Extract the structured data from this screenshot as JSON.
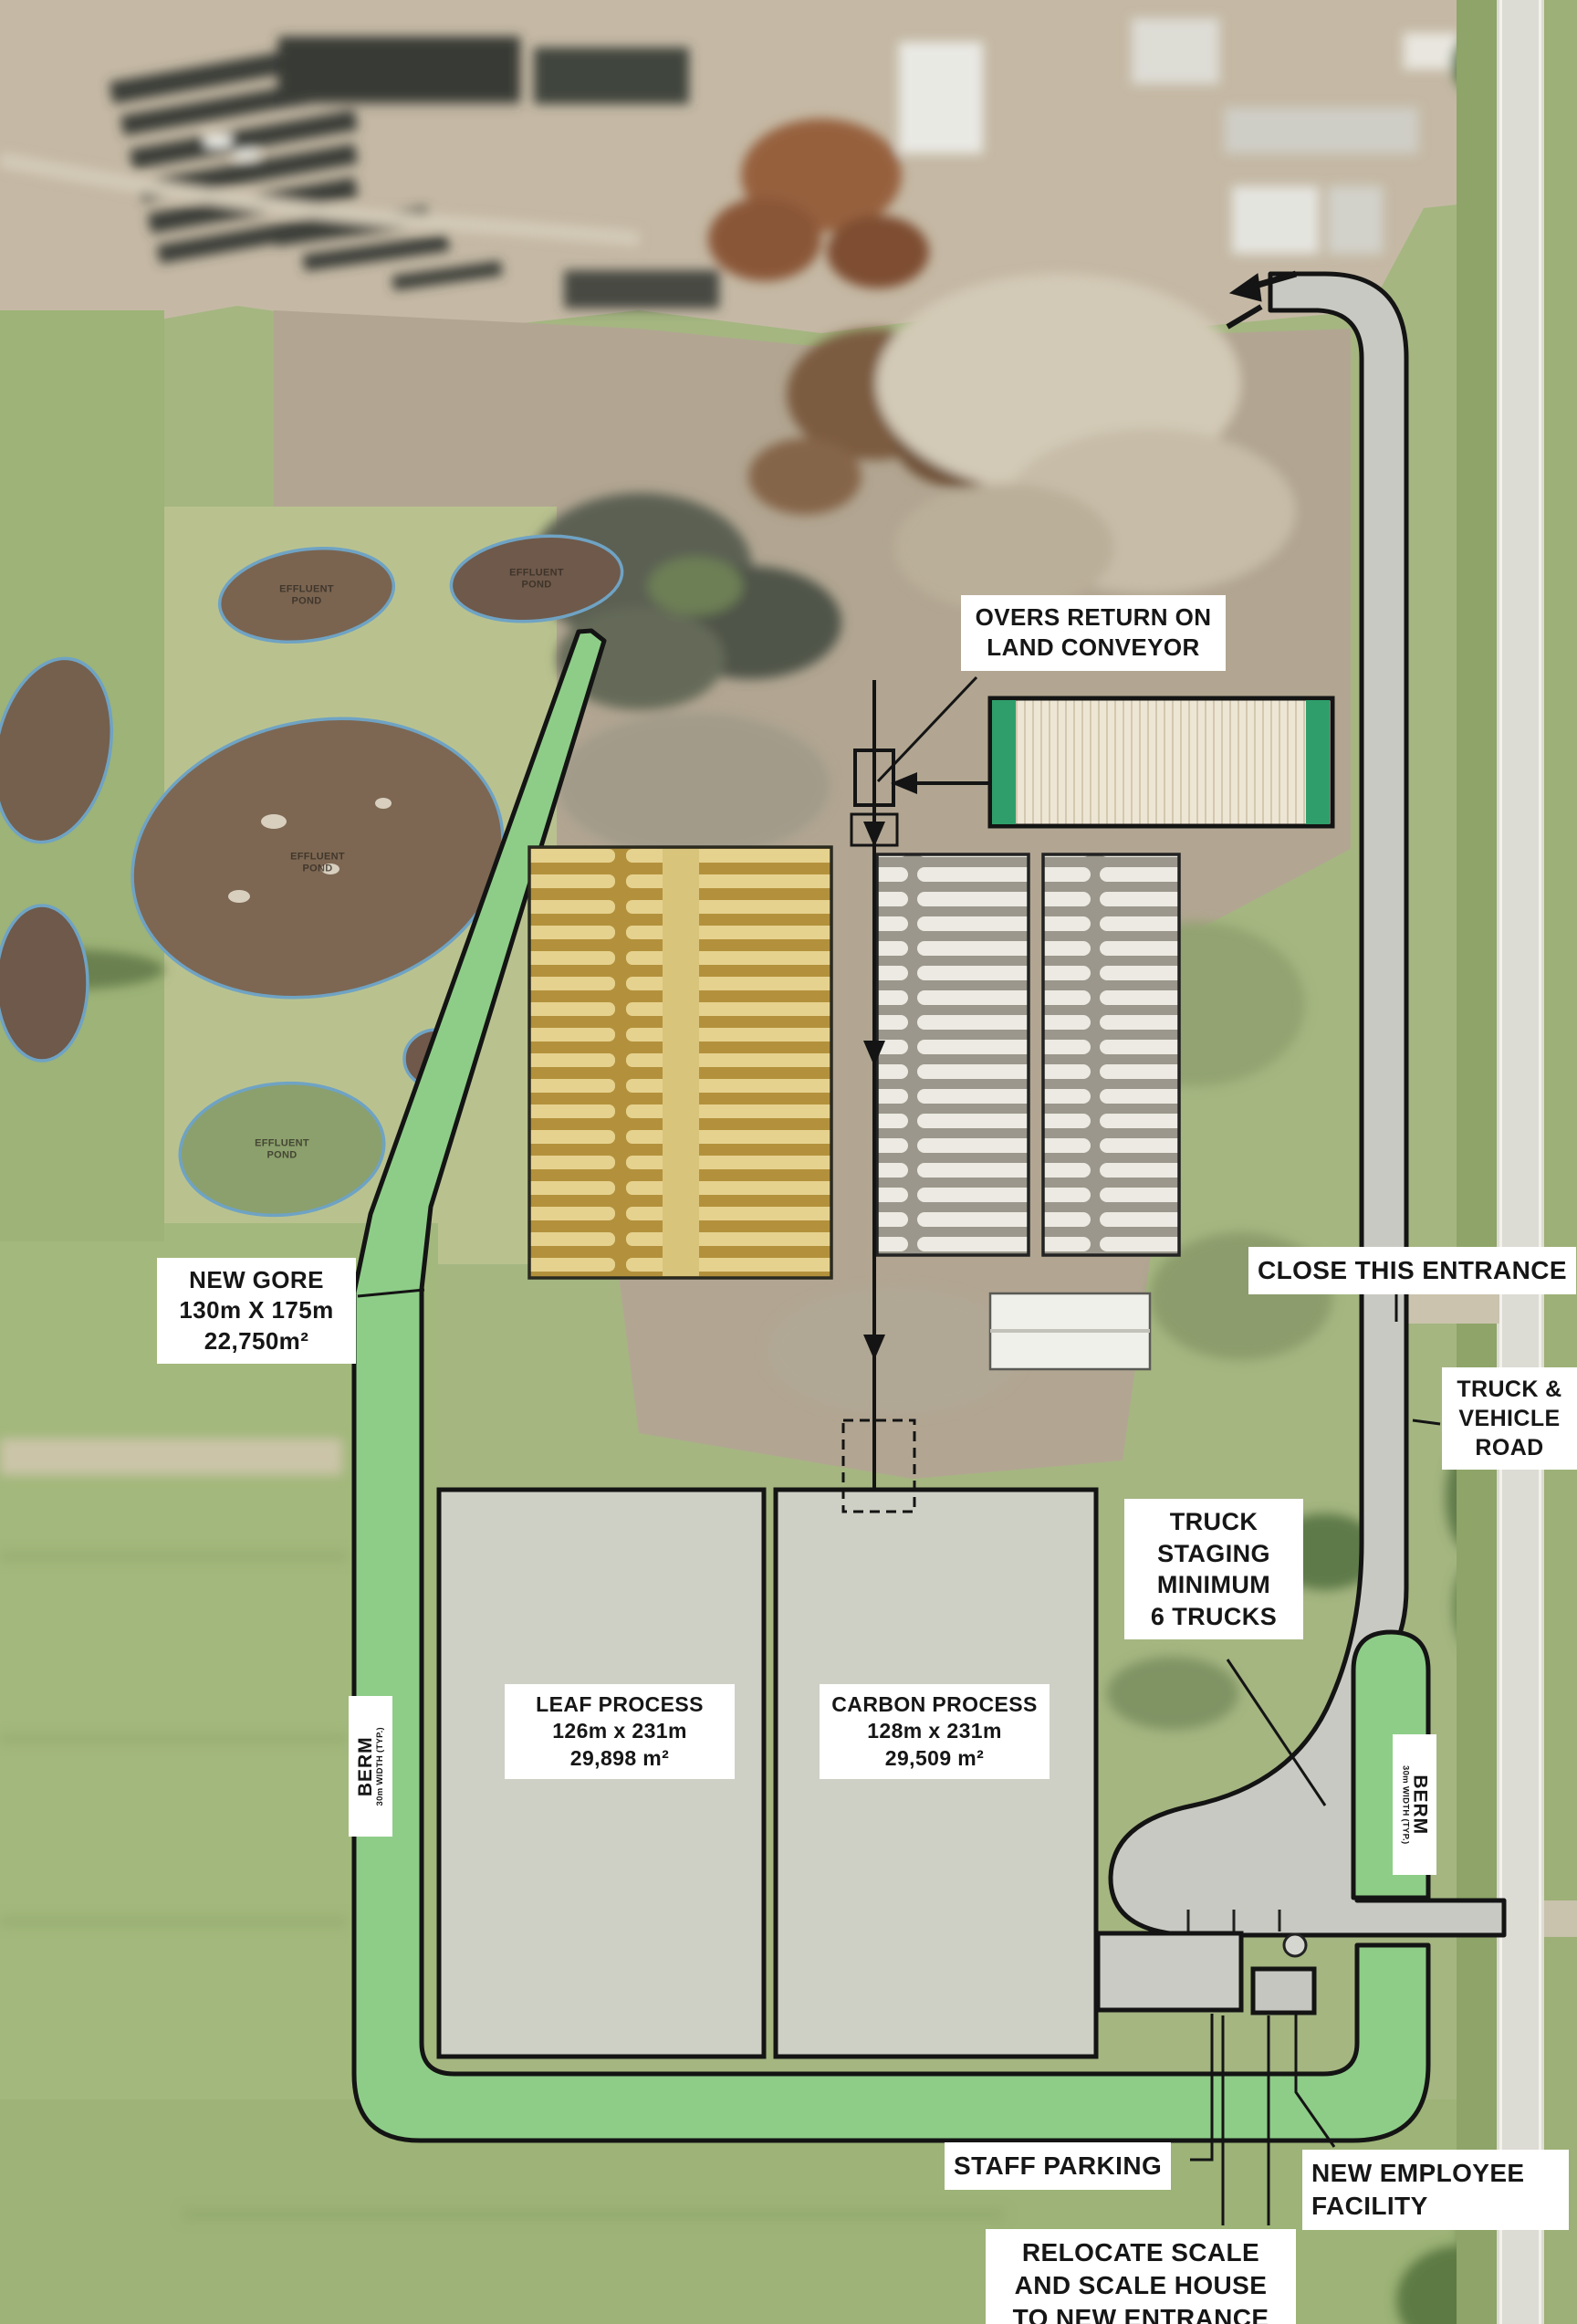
{
  "colors": {
    "berm_green": "#8ecd88",
    "road_gray": "#c9c9c3",
    "process_gray": "#d1d2ca",
    "windrow_yellow": "#c2a14c",
    "outline_black": "#141414",
    "label_bg": "#ffffff",
    "label_text": "#161616"
  },
  "annotations": {
    "overs_return": "OVERS RETURN ON\nLAND CONVEYOR",
    "new_gore": "NEW GORE\n130m X 175m\n22,750m²",
    "close_entrance": "CLOSE THIS ENTRANCE",
    "truck_vehicle_road": "TRUCK &\nVEHICLE\nROAD",
    "truck_staging": "TRUCK\nSTAGING\nMINIMUM\n6 TRUCKS",
    "leaf_process": "LEAF PROCESS\n126m x 231m\n29,898 m²",
    "carbon_process": "CARBON PROCESS\n128m x 231m\n29,509 m²",
    "berm_left_title": "BERM",
    "berm_left_sub": "30m WIDTH (TYP.)",
    "berm_right_title": "BERM",
    "berm_right_sub": "30m WIDTH (TYP.)",
    "staff_parking": "STAFF PARKING",
    "new_employee_facility": "NEW EMPLOYEE\nFACILITY",
    "relocate_scale": "RELOCATE SCALE\nAND SCALE HOUSE\nTO NEW ENTRANCE"
  },
  "base_map_labels": {
    "ponds": [
      "EFFLUENT\nPOND",
      "EFFLUENT\nPOND",
      "EFFLUENT\nPOND",
      "EFFLUENT\nPOND"
    ]
  }
}
